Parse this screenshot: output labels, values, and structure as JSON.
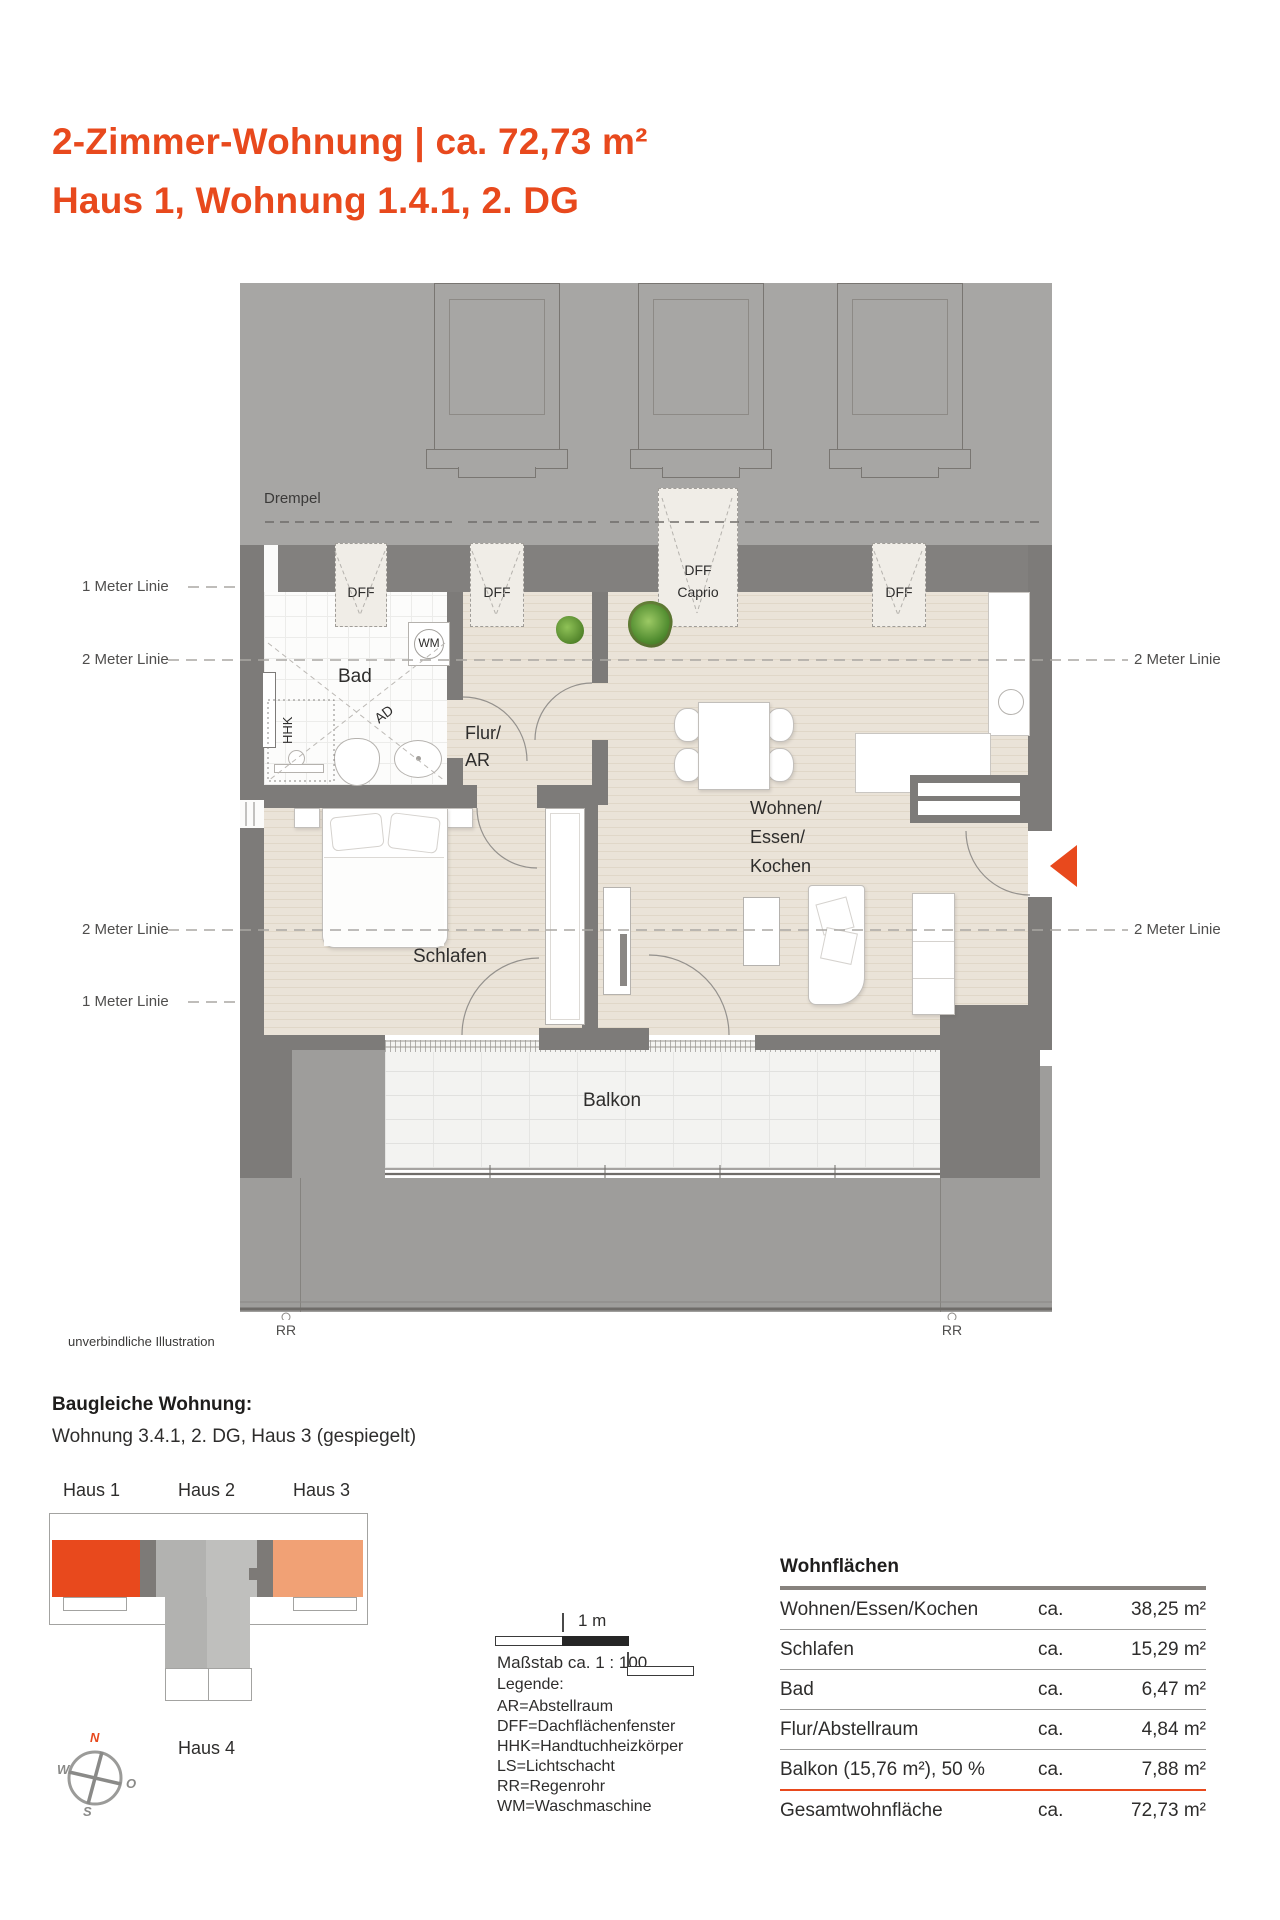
{
  "header": {
    "title_line1": "2-Zimmer-Wohnung | ca. 72,73 m²",
    "title_line2": "Haus 1, Wohnung 1.4.1, 2. DG"
  },
  "plan": {
    "drempel": "Drempel",
    "windows": {
      "dff": "DFF",
      "caprio_line2": "Caprio"
    },
    "rooms": {
      "bad": "Bad",
      "flur_line1": "Flur/",
      "flur_line2": "AR",
      "schlafen": "Schlafen",
      "wohnen_line1": "Wohnen/",
      "wohnen_line2": "Essen/",
      "wohnen_line3": "Kochen",
      "balkon": "Balkon"
    },
    "items": {
      "wm": "WM",
      "hhk": "HHK",
      "ad": "AD",
      "rr": "RR"
    },
    "meter_lines": {
      "meter1": "1 Meter Linie",
      "meter2": "2 Meter Linie"
    },
    "disclaimer": "unverbindliche Illustration"
  },
  "variant": {
    "heading": "Baugleiche Wohnung:",
    "text": "Wohnung 3.4.1, 2. DG, Haus 3 (gespiegelt)"
  },
  "siteplan": {
    "haus1": "Haus 1",
    "haus2": "Haus 2",
    "haus3": "Haus 3",
    "haus4": "Haus 4",
    "compass": {
      "n": "N",
      "o": "O",
      "s": "S",
      "w": "W"
    }
  },
  "scalebar": {
    "label": "1 m",
    "caption": "Maßstab ca. 1 : 100"
  },
  "legend": {
    "heading": "Legende:",
    "items": [
      "AR=Abstellraum",
      "DFF=Dachflächenfenster",
      "HHK=Handtuchheizkörper",
      "LS=Lichtschacht",
      "RR=Regenrohr",
      "WM=Waschmaschine"
    ]
  },
  "areas": {
    "heading": "Wohnflächen",
    "ca": "ca.",
    "rows": [
      {
        "name": "Wohnen/Essen/Kochen",
        "value": "38,25 m²"
      },
      {
        "name": "Schlafen",
        "value": "15,29 m²"
      },
      {
        "name": "Bad",
        "value": "6,47 m²"
      },
      {
        "name": "Flur/Abstellraum",
        "value": "4,84 m²"
      },
      {
        "name": "Balkon (15,76 m²), 50 %",
        "value": "7,88 m²"
      },
      {
        "name": "Gesamtwohnfläche",
        "value": "72,73 m²"
      }
    ]
  },
  "colors": {
    "accent": "#e8491d",
    "haus3_fill": "#f1a175"
  }
}
